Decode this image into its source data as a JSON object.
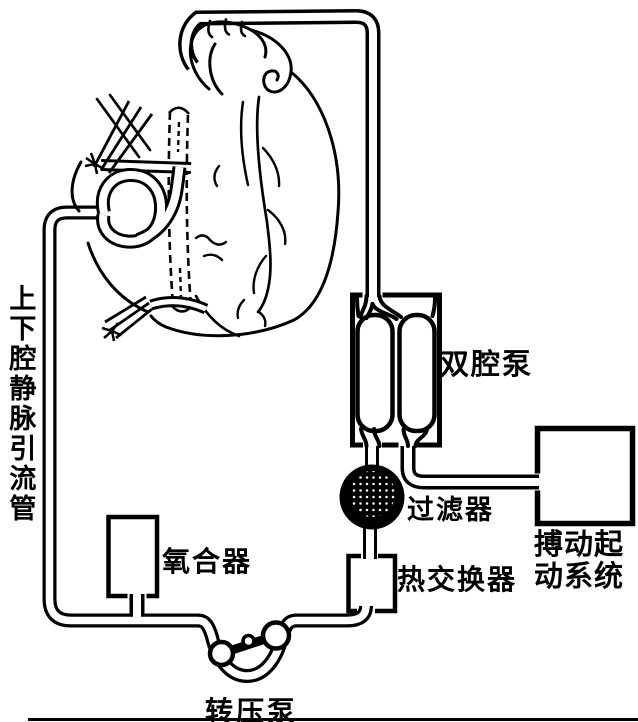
{
  "figure": {
    "labels": {
      "venous_drainage_tube": "上下腔静脉引流管",
      "dual_chamber_pump": "双腔泵",
      "filter": "过滤器",
      "heat_exchanger": "热交换器",
      "pulsatile_drive_system": "搏动起动系统",
      "oxygenator": "氧合器",
      "roller_pump": "转压泵"
    },
    "colors": {
      "ink": "#000000",
      "paper": "#ffffff"
    }
  }
}
